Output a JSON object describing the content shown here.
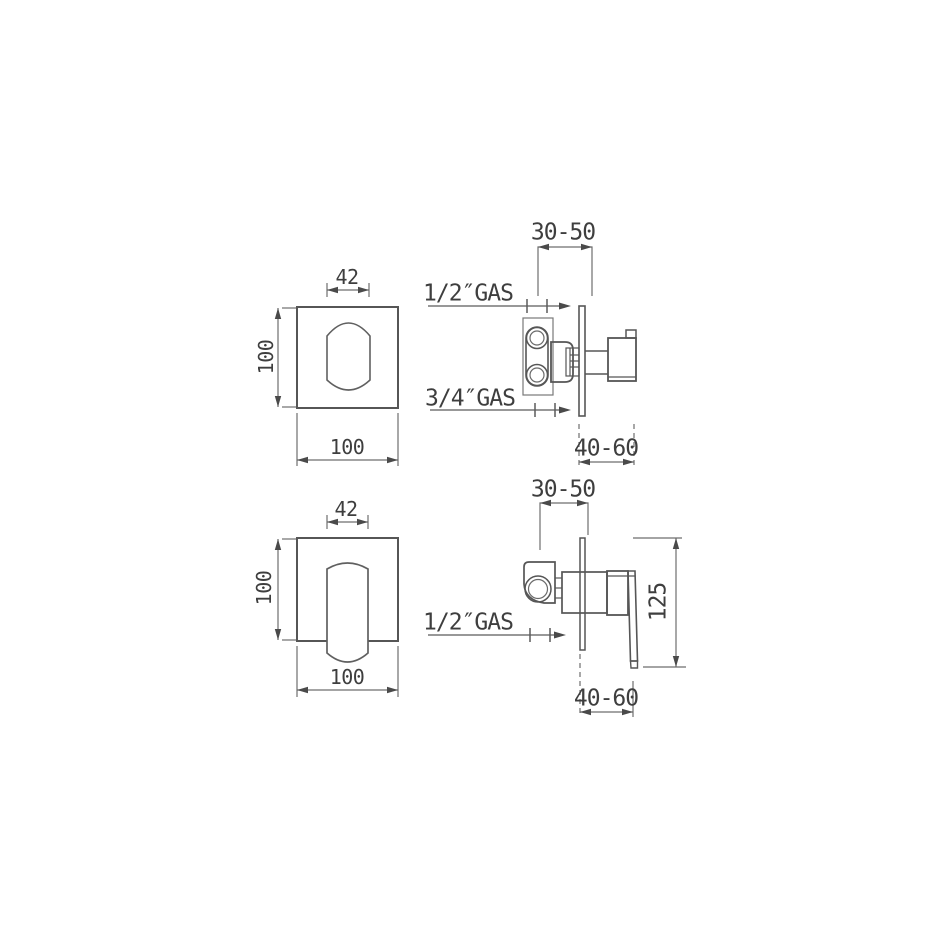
{
  "drawing": {
    "background": "#ffffff",
    "line_color": "#565656",
    "dim_color": "#6e6e6e",
    "text_color": "#3e3e3e",
    "views": {
      "diverter_front": {
        "labels": {
          "cutout_width": "42",
          "plate_height": "100",
          "plate_width": "100"
        }
      },
      "diverter_side": {
        "labels": {
          "recess_depth": "30-50",
          "top_inlet": "1/2″GAS",
          "bottom_inlet": "3/4″GAS",
          "projection": "40-60"
        }
      },
      "mixer_front": {
        "labels": {
          "cutout_width": "42",
          "plate_height": "100",
          "plate_width": "100"
        }
      },
      "mixer_side": {
        "labels": {
          "recess_depth": "30-50",
          "inlet": "1/2″GAS",
          "overall_height": "125",
          "projection": "40-60"
        }
      }
    }
  }
}
